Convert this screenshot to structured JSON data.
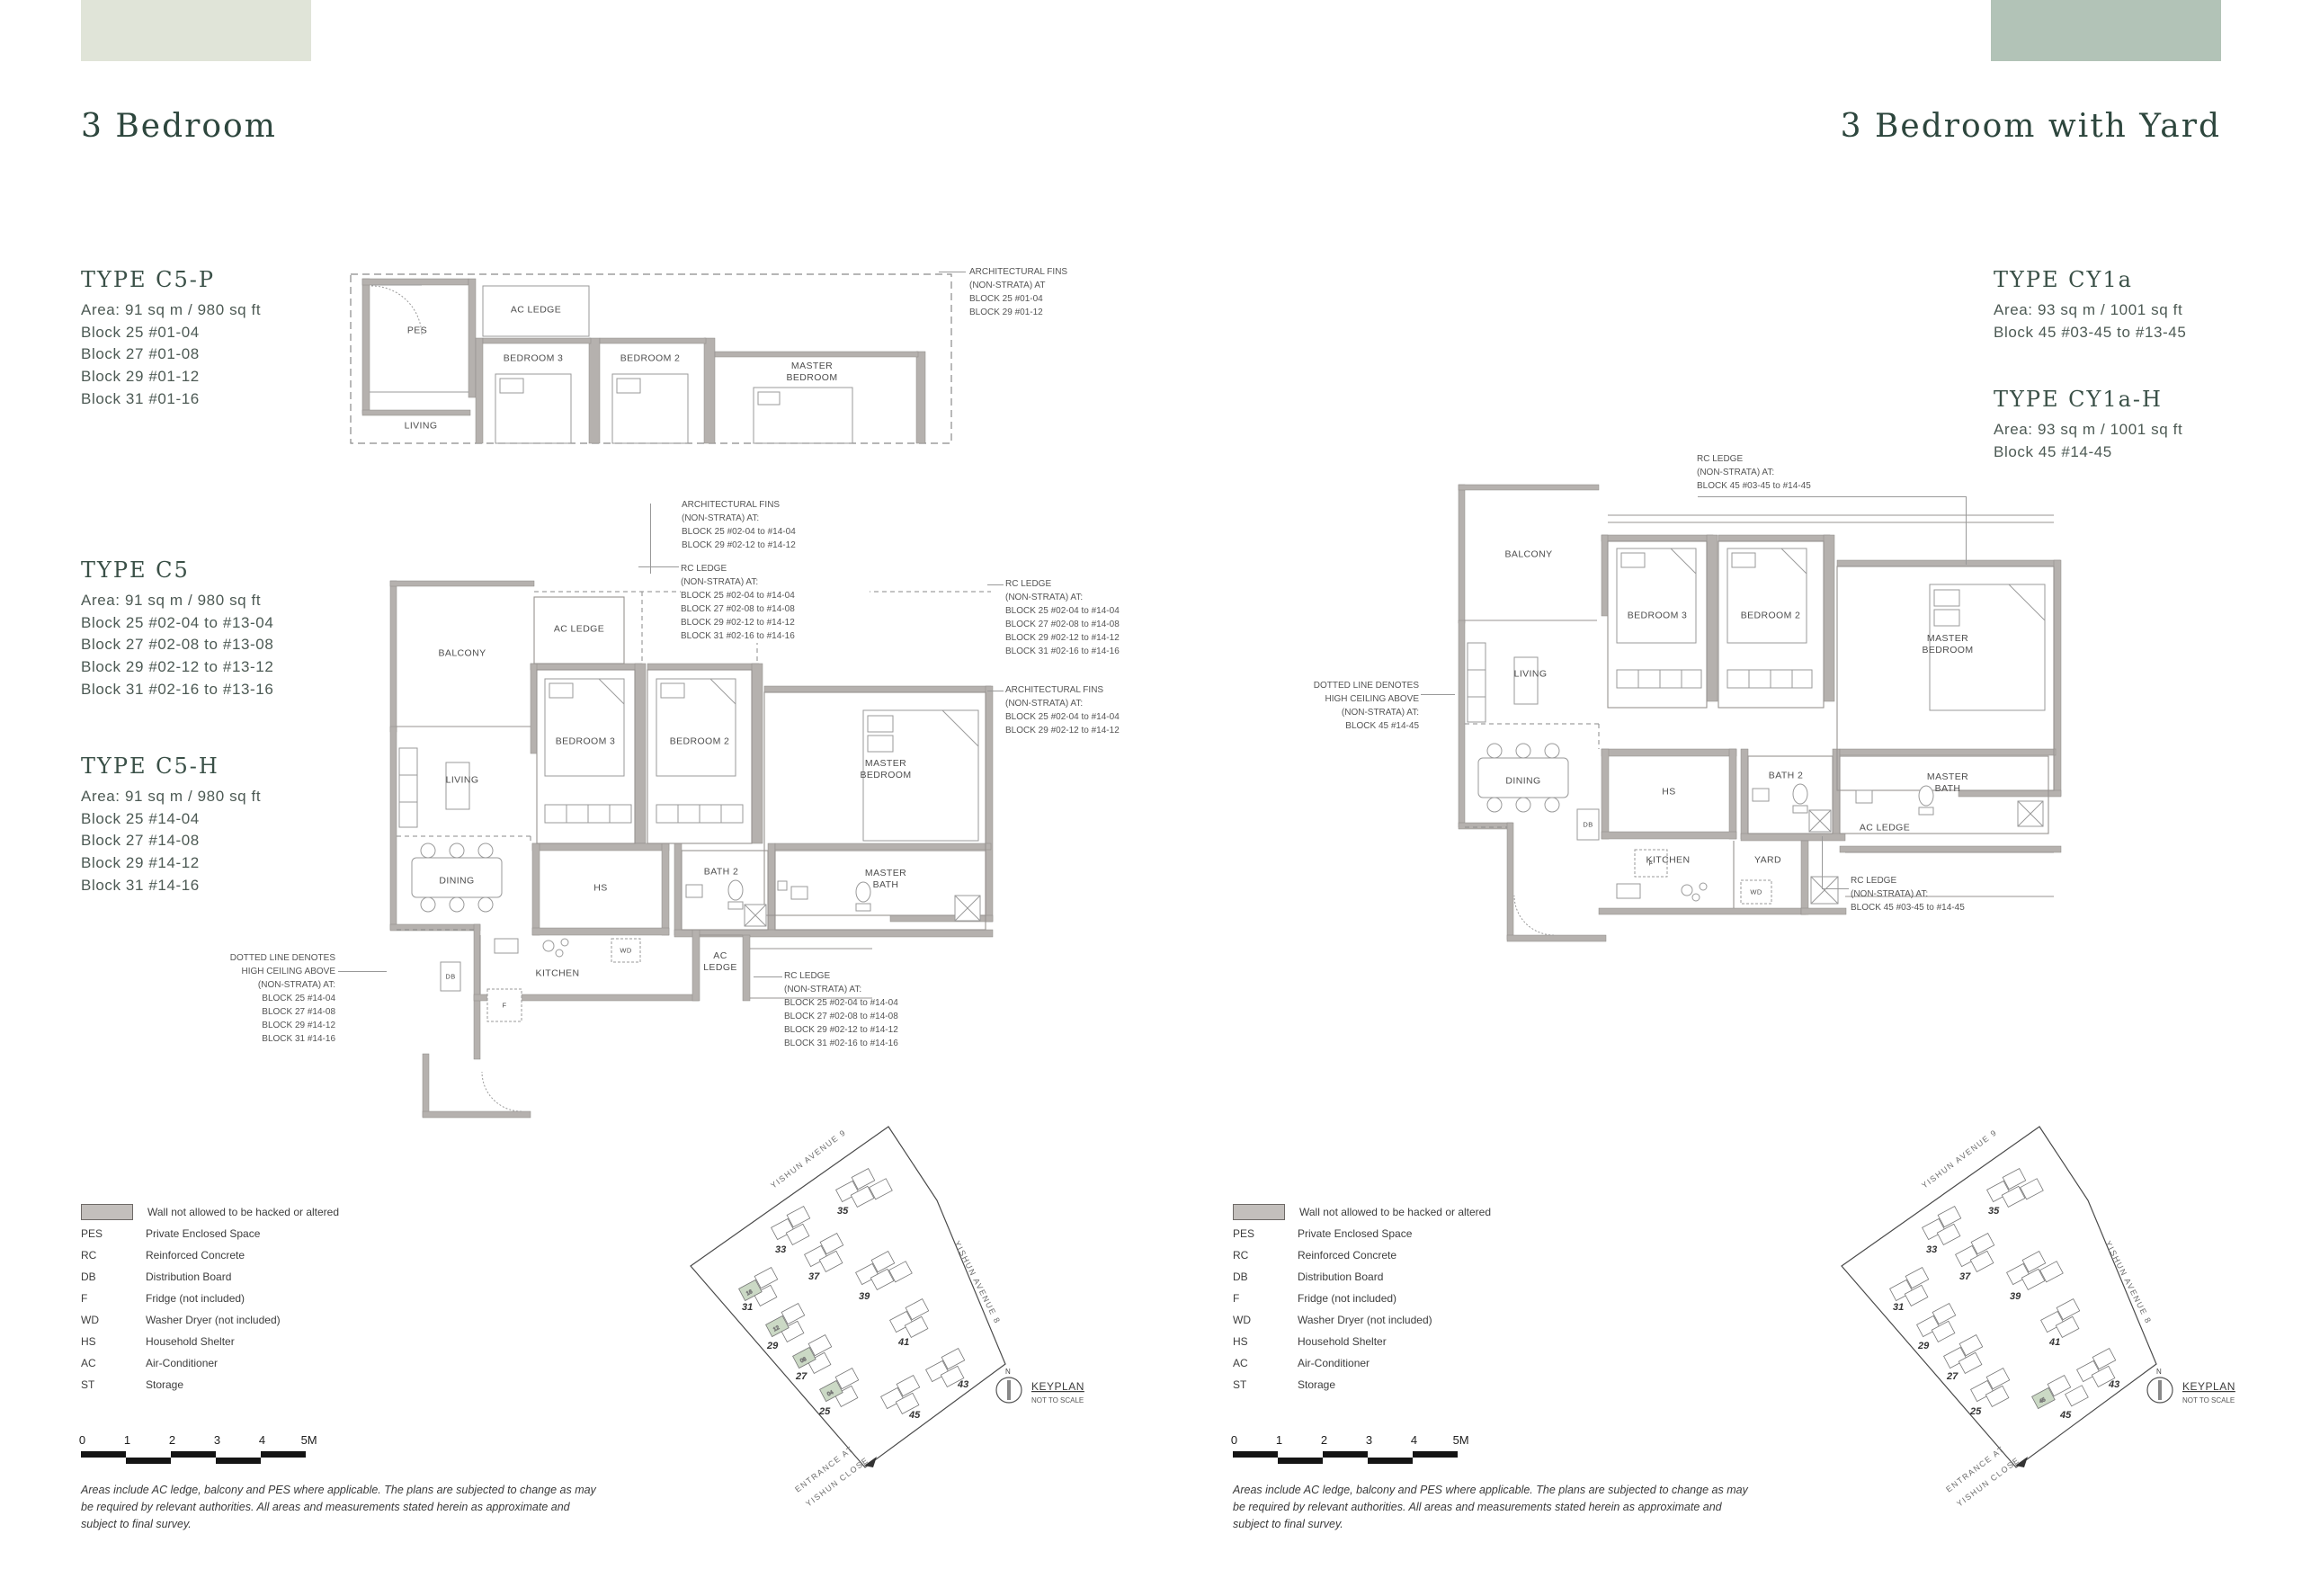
{
  "left": {
    "section_title": "3 Bedroom",
    "types": [
      {
        "name": "TYPE C5-P",
        "area": "Area: 91 sq m / 980 sq ft",
        "blocks": [
          "Block 25 #01-04",
          "Block 27 #01-08",
          "Block 29 #01-12",
          "Block 31 #01-16"
        ]
      },
      {
        "name": "TYPE C5",
        "area": "Area: 91 sq m / 980 sq ft",
        "blocks": [
          "Block 25 #02-04 to #13-04",
          "Block 27 #02-08 to #13-08",
          "Block 29 #02-12 to #13-12",
          "Block 31 #02-16 to #13-16"
        ]
      },
      {
        "name": "TYPE C5-H",
        "area": "Area: 91 sq m / 980 sq ft",
        "blocks": [
          "Block 25 #14-04",
          "Block 27 #14-08",
          "Block 29 #14-12",
          "Block 31 #14-16"
        ]
      }
    ],
    "strip_plan": {
      "rooms": {
        "pes": "PES",
        "ac_ledge": "AC LEDGE",
        "living": "LIVING",
        "bedroom3": "BEDROOM 3",
        "bedroom2": "BEDROOM 2",
        "master_bedroom": "MASTER\nBEDROOM"
      },
      "fins_note": "ARCHITECTURAL FINS\n(NON-STRATA) AT\nBLOCK 25 #01-04\nBLOCK 29 #01-12"
    },
    "main_plan": {
      "rooms": {
        "balcony": "BALCONY",
        "ac_ledge_top": "AC LEDGE",
        "living": "LIVING",
        "dining": "DINING",
        "bedroom3": "BEDROOM 3",
        "bedroom2": "BEDROOM 2",
        "master_bedroom": "MASTER\nBEDROOM",
        "hs": "HS",
        "bath2": "BATH 2",
        "master_bath": "MASTER\nBATH",
        "kitchen": "KITCHEN",
        "ac_ledge_bottom": "AC\nLEDGE",
        "db": "DB",
        "f": "F",
        "wd": "WD"
      },
      "notes": {
        "fins_top": "ARCHITECTURAL FINS\n(NON-STRATA) AT:\nBLOCK 25 #02-04 to #14-04\nBLOCK 29 #02-12 to #14-12",
        "rc_ledge_top": "RC LEDGE\n(NON-STRATA) AT:\nBLOCK 25 #02-04 to #14-04\nBLOCK 27 #02-08 to #14-08\nBLOCK 29 #02-12 to #14-12\nBLOCK 31 #02-16 to #14-16",
        "rc_ledge_right": "RC LEDGE\n(NON-STRATA) AT:\nBLOCK 25 #02-04 to #14-04\nBLOCK 27 #02-08 to #14-08\nBLOCK 29 #02-12 to #14-12\nBLOCK 31 #02-16 to #14-16",
        "fins_right": "ARCHITECTURAL FINS\n(NON-STRATA) AT:\nBLOCK 25 #02-04 to #14-04\nBLOCK 29 #02-12 to #14-12",
        "high_ceiling": "DOTTED LINE DENOTES\nHIGH CEILING ABOVE\n(NON-STRATA) AT:\nBLOCK 25 #14-04\nBLOCK 27 #14-08\nBLOCK 29 #14-12\nBLOCK 31 #14-16",
        "rc_ledge_bottom": "RC LEDGE\n(NON-STRATA) AT:\nBLOCK 25 #02-04 to #14-04\nBLOCK 27 #02-08 to #14-08\nBLOCK 29 #02-12 to #14-12\nBLOCK 31 #02-16 to #14-16"
      }
    }
  },
  "right": {
    "section_title": "3 Bedroom with Yard",
    "types": [
      {
        "name": "TYPE CY1a",
        "area": "Area: 93 sq m / 1001 sq ft",
        "blocks": [
          "Block 45 #03-45 to #13-45"
        ]
      },
      {
        "name": "TYPE CY1a-H",
        "area": "Area: 93 sq m / 1001 sq ft",
        "blocks": [
          "Block 45 #14-45"
        ]
      }
    ],
    "main_plan": {
      "rooms": {
        "balcony": "BALCONY",
        "living": "LIVING",
        "dining": "DINING",
        "bedroom3": "BEDROOM 3",
        "bedroom2": "BEDROOM 2",
        "master_bedroom": "MASTER\nBEDROOM",
        "hs": "HS",
        "bath2": "BATH 2",
        "master_bath": "MASTER\nBATH",
        "kitchen": "KITCHEN",
        "yard": "YARD",
        "ac_ledge": "AC LEDGE",
        "db": "DB",
        "f": "F",
        "wd": "WD"
      },
      "notes": {
        "rc_ledge_top": "RC LEDGE\n(NON-STRATA) AT:\nBLOCK 45 #03-45 to #14-45",
        "high_ceiling": "DOTTED LINE DENOTES\nHIGH CEILING ABOVE\n(NON-STRATA) AT:\nBLOCK 45 #14-45",
        "rc_ledge_bottom": "RC LEDGE\n(NON-STRATA) AT:\nBLOCK 45 #03-45 to #14-45"
      }
    }
  },
  "legend": {
    "wall_label": "Wall not allowed to be hacked or altered",
    "items": [
      {
        "abbr": "PES",
        "label": "Private Enclosed Space"
      },
      {
        "abbr": "RC",
        "label": "Reinforced Concrete"
      },
      {
        "abbr": "DB",
        "label": "Distribution Board"
      },
      {
        "abbr": "F",
        "label": "Fridge (not included)"
      },
      {
        "abbr": "WD",
        "label": "Washer Dryer (not included)"
      },
      {
        "abbr": "HS",
        "label": "Household Shelter"
      },
      {
        "abbr": "AC",
        "label": "Air-Conditioner"
      },
      {
        "abbr": "ST",
        "label": "Storage"
      }
    ]
  },
  "scale_bar": {
    "ticks": [
      "0",
      "1",
      "2",
      "3",
      "4",
      "5M"
    ]
  },
  "disclaimer": "Areas include AC ledge, balcony and PES where applicable. The plans are subjected to change as may be required by relevant authorities. All areas and measurements stated herein as approximate and subject to final survey.",
  "keyplan": {
    "title": "KEYPLAN",
    "subtitle": "NOT TO SCALE",
    "north": "N",
    "street_top": "YISHUN AVENUE 9",
    "street_right": "YISHUN AVENUE 8",
    "entrance_line1": "ENTRANCE AT",
    "entrance_line2": "YISHUN CLOSE",
    "blocks": [
      "25",
      "27",
      "29",
      "31",
      "33",
      "35",
      "37",
      "39",
      "41",
      "43",
      "45"
    ],
    "left_highlight_stacks": [
      "04",
      "08",
      "12",
      "16"
    ],
    "right_highlight_stack": "45",
    "highlight_color": "#cbd9c5"
  },
  "colors": {
    "deco_left": "#e0e4d8",
    "deco_right": "#b2c3b7",
    "wall": "#b5b1ae"
  }
}
